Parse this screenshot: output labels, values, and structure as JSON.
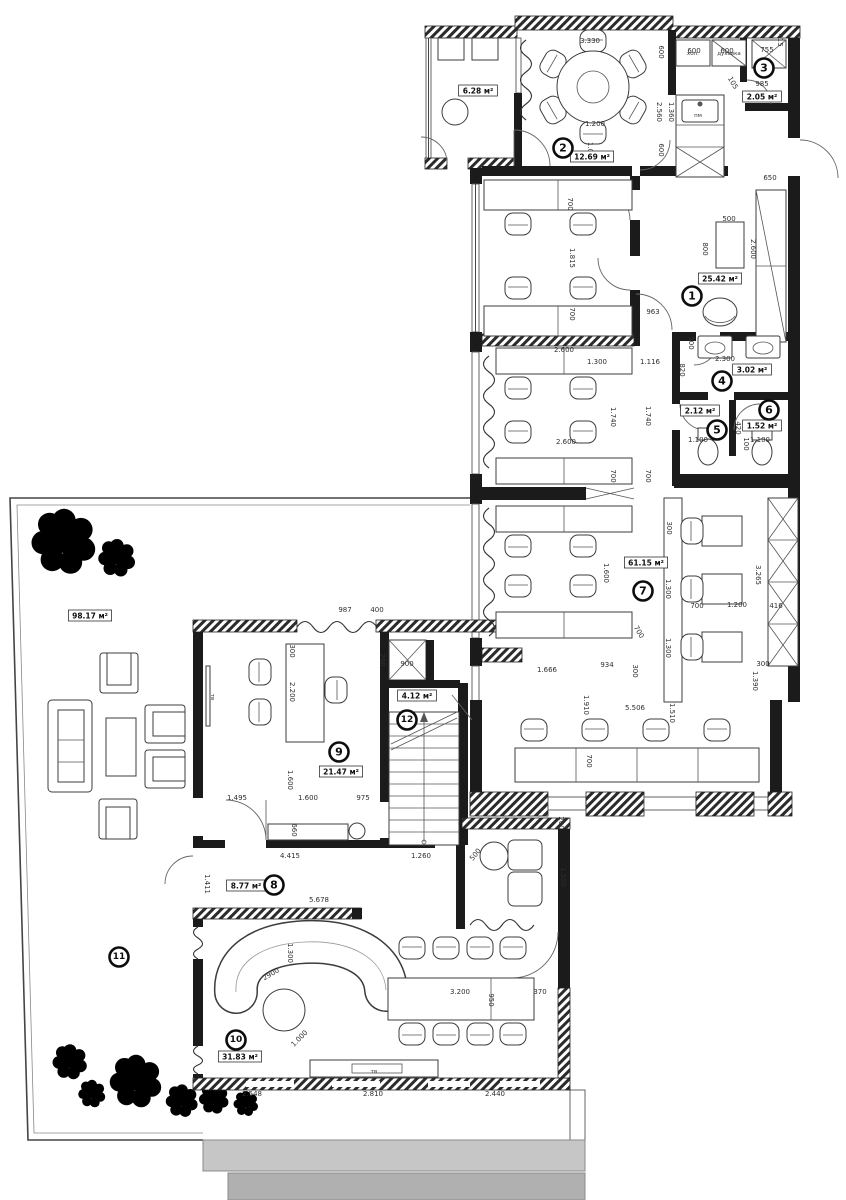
{
  "drawing": {
    "type": "architectural floor plan",
    "area_unit": "м²"
  },
  "rooms": [
    {
      "number": "1",
      "area": "25.42 м²",
      "marker": {
        "x": 692,
        "y": 296
      },
      "area_label": {
        "x": 720,
        "y": 279
      }
    },
    {
      "number": "2",
      "area": "12.69 м²",
      "marker": {
        "x": 563,
        "y": 148
      },
      "area_label": {
        "x": 592,
        "y": 157
      }
    },
    {
      "number": "3",
      "area": "2.05 м²",
      "marker": {
        "x": 764,
        "y": 68
      },
      "area_label": {
        "x": 762,
        "y": 97
      }
    },
    {
      "number": "4",
      "area": "3.02 м²",
      "marker": {
        "x": 722,
        "y": 381
      },
      "area_label": {
        "x": 752,
        "y": 370
      }
    },
    {
      "number": "5",
      "area": "2.12 м²",
      "marker": {
        "x": 717,
        "y": 430
      },
      "area_label": {
        "x": 700,
        "y": 411
      }
    },
    {
      "number": "6",
      "area": "1.52 м²",
      "marker": {
        "x": 769,
        "y": 410
      },
      "area_label": {
        "x": 762,
        "y": 426
      }
    },
    {
      "number": "7",
      "area": "61.15 м²",
      "marker": {
        "x": 643,
        "y": 591
      },
      "area_label": {
        "x": 646,
        "y": 563
      }
    },
    {
      "number": "8",
      "area": "8.77 м²",
      "marker": {
        "x": 274,
        "y": 885
      },
      "area_label": {
        "x": 246,
        "y": 886
      }
    },
    {
      "number": "9",
      "area": "21.47 м²",
      "marker": {
        "x": 339,
        "y": 752
      },
      "area_label": {
        "x": 341,
        "y": 772
      }
    },
    {
      "number": "10",
      "area": "31.83 м²",
      "marker": {
        "x": 236,
        "y": 1040
      },
      "area_label": {
        "x": 240,
        "y": 1057
      }
    },
    {
      "number": "11",
      "area": "98.17 м²",
      "marker": {
        "x": 119,
        "y": 957
      },
      "area_label": {
        "x": 90,
        "y": 616
      }
    },
    {
      "number": "12",
      "area": "4.12 м²",
      "marker": {
        "x": 407,
        "y": 720
      },
      "area_label": {
        "x": 417,
        "y": 696
      }
    }
  ],
  "unnumbered_areas": [
    {
      "area": "6.28 м²",
      "x": 478,
      "y": 91
    }
  ],
  "dimensions": [
    {
      "t": "3.330",
      "x": 590,
      "y": 43
    },
    {
      "t": "600",
      "x": 694,
      "y": 53
    },
    {
      "t": "600",
      "x": 727,
      "y": 53
    },
    {
      "t": "755",
      "x": 767,
      "y": 52
    },
    {
      "t": "415",
      "x": 778,
      "y": 40,
      "r": 90
    },
    {
      "t": "985",
      "x": 762,
      "y": 86
    },
    {
      "t": "105",
      "x": 731,
      "y": 84,
      "r": 60
    },
    {
      "t": "600",
      "x": 659,
      "y": 52,
      "r": 90
    },
    {
      "t": "2.560",
      "x": 657,
      "y": 112,
      "r": 90
    },
    {
      "t": "1.360",
      "x": 669,
      "y": 112,
      "r": 90
    },
    {
      "t": "600",
      "x": 659,
      "y": 150,
      "r": 90
    },
    {
      "t": "1.200",
      "x": 595,
      "y": 126
    },
    {
      "t": "1.000",
      "x": 588,
      "y": 152,
      "r": 90
    },
    {
      "t": "650",
      "x": 770,
      "y": 180
    },
    {
      "t": "500",
      "x": 729,
      "y": 221
    },
    {
      "t": "800",
      "x": 703,
      "y": 249,
      "r": 90
    },
    {
      "t": "2.600",
      "x": 751,
      "y": 249,
      "r": 90
    },
    {
      "t": "700",
      "x": 568,
      "y": 204,
      "r": 90
    },
    {
      "t": "1.815",
      "x": 570,
      "y": 258,
      "r": 90
    },
    {
      "t": "700",
      "x": 570,
      "y": 314,
      "r": 90
    },
    {
      "t": "963",
      "x": 653,
      "y": 314
    },
    {
      "t": "500",
      "x": 689,
      "y": 343,
      "r": 90
    },
    {
      "t": "2.300",
      "x": 725,
      "y": 361
    },
    {
      "t": "2.600",
      "x": 564,
      "y": 352
    },
    {
      "t": "1.300",
      "x": 597,
      "y": 364
    },
    {
      "t": "1.116",
      "x": 650,
      "y": 364
    },
    {
      "t": "820",
      "x": 680,
      "y": 370,
      "r": 90
    },
    {
      "t": "1.740",
      "x": 611,
      "y": 417,
      "r": 90
    },
    {
      "t": "1.740",
      "x": 646,
      "y": 416,
      "r": 90
    },
    {
      "t": "2.600",
      "x": 566,
      "y": 444
    },
    {
      "t": "700",
      "x": 611,
      "y": 476,
      "r": 90
    },
    {
      "t": "700",
      "x": 646,
      "y": 476,
      "r": 90
    },
    {
      "t": "1.100",
      "x": 698,
      "y": 442
    },
    {
      "t": "420",
      "x": 736,
      "y": 428,
      "r": 90
    },
    {
      "t": "100",
      "x": 744,
      "y": 444,
      "r": 90
    },
    {
      "t": "1.100",
      "x": 760,
      "y": 442
    },
    {
      "t": "300",
      "x": 667,
      "y": 528,
      "r": 90
    },
    {
      "t": "1.600",
      "x": 604,
      "y": 573,
      "r": 90
    },
    {
      "t": "1.300",
      "x": 666,
      "y": 589,
      "r": 90
    },
    {
      "t": "3.265",
      "x": 756,
      "y": 575,
      "r": 90
    },
    {
      "t": "700",
      "x": 697,
      "y": 608
    },
    {
      "t": "1.200",
      "x": 737,
      "y": 607
    },
    {
      "t": "416",
      "x": 776,
      "y": 608
    },
    {
      "t": "1.300",
      "x": 666,
      "y": 648,
      "r": 90
    },
    {
      "t": "700",
      "x": 637,
      "y": 633,
      "r": 60
    },
    {
      "t": "300",
      "x": 763,
      "y": 666
    },
    {
      "t": "1.390",
      "x": 753,
      "y": 681,
      "r": 90
    },
    {
      "t": "934",
      "x": 607,
      "y": 667
    },
    {
      "t": "300",
      "x": 633,
      "y": 671,
      "r": 90
    },
    {
      "t": "1.666",
      "x": 547,
      "y": 672
    },
    {
      "t": "1.910",
      "x": 584,
      "y": 705,
      "r": 90
    },
    {
      "t": "5.506",
      "x": 635,
      "y": 710
    },
    {
      "t": "1.510",
      "x": 670,
      "y": 713,
      "r": 90
    },
    {
      "t": "700",
      "x": 587,
      "y": 761,
      "r": 90
    },
    {
      "t": "987",
      "x": 345,
      "y": 612
    },
    {
      "t": "400",
      "x": 377,
      "y": 612
    },
    {
      "t": "300",
      "x": 290,
      "y": 651,
      "r": 90
    },
    {
      "t": "2.200",
      "x": 290,
      "y": 692,
      "r": 90
    },
    {
      "t": "790",
      "x": 380,
      "y": 660,
      "r": 90
    },
    {
      "t": "900",
      "x": 407,
      "y": 666
    },
    {
      "t": "1.600",
      "x": 288,
      "y": 780,
      "r": 90
    },
    {
      "t": "1.495",
      "x": 237,
      "y": 800
    },
    {
      "t": "1.600",
      "x": 308,
      "y": 800
    },
    {
      "t": "975",
      "x": 363,
      "y": 800
    },
    {
      "t": "660",
      "x": 292,
      "y": 830,
      "r": 90
    },
    {
      "t": "200",
      "x": 559,
      "y": 823,
      "r": 90
    },
    {
      "t": "4.415",
      "x": 290,
      "y": 858
    },
    {
      "t": "1.260",
      "x": 421,
      "y": 858
    },
    {
      "t": "1.411",
      "x": 205,
      "y": 884,
      "r": 90
    },
    {
      "t": "5.678",
      "x": 319,
      "y": 902
    },
    {
      "t": "500",
      "x": 477,
      "y": 856,
      "r": -50
    },
    {
      "t": "1.500",
      "x": 561,
      "y": 877,
      "r": 90
    },
    {
      "t": "1.300",
      "x": 288,
      "y": 953,
      "r": 90
    },
    {
      "t": "2900",
      "x": 272,
      "y": 976,
      "r": -30
    },
    {
      "t": "1.000",
      "x": 301,
      "y": 1040,
      "r": -45
    },
    {
      "t": "3.200",
      "x": 460,
      "y": 994
    },
    {
      "t": "950",
      "x": 489,
      "y": 1000,
      "r": 90
    },
    {
      "t": "370",
      "x": 540,
      "y": 994
    },
    {
      "t": "2.548",
      "x": 252,
      "y": 1096
    },
    {
      "t": "2.810",
      "x": 373,
      "y": 1096
    },
    {
      "t": "2.440",
      "x": 495,
      "y": 1096
    }
  ],
  "fixture_labels": [
    {
      "t": "пм",
      "x": 698,
      "y": 117
    },
    {
      "t": "хол.",
      "x": 693,
      "y": 55
    },
    {
      "t": "духовка",
      "x": 729,
      "y": 55
    },
    {
      "t": "тв",
      "x": 374,
      "y": 1073
    },
    {
      "t": "тв",
      "x": 211,
      "y": 697,
      "r": 90
    }
  ],
  "colors": {
    "paper": "#ffffff",
    "wall": "#1b1b1b",
    "tree_fill": "#dcead0",
    "tree_stroke": "#6a8d56",
    "steps_upper": "#c6c6c6",
    "steps_lower": "#b0b0b0"
  }
}
